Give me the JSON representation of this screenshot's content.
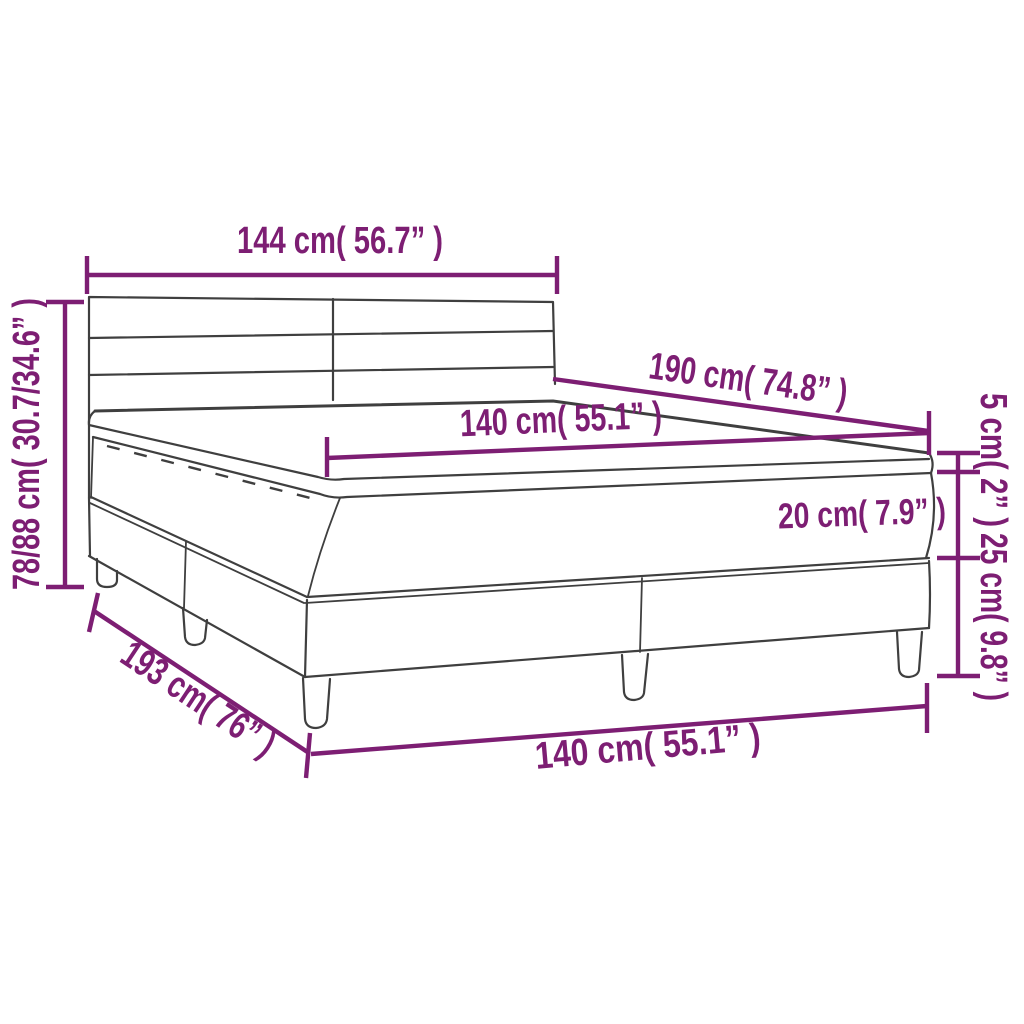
{
  "diagram": {
    "subject": "box spring bed with mattress and topper dimension drawing",
    "colors": {
      "accent": "#7d1e73",
      "line_art": "#3f3f3f",
      "background": "#ffffff"
    },
    "measurements": {
      "headboard_width": {
        "cm": "144",
        "inches": "56.7",
        "label": "144 cm( 56.7” )"
      },
      "total_height": {
        "cm": "78/88",
        "inches": "30.7/34.6",
        "label": "78/88 cm( 30.7/34.6” )"
      },
      "bed_length": {
        "cm": "190",
        "inches": "74.8",
        "label": "190 cm( 74.8” )"
      },
      "mattress_width": {
        "cm": "140",
        "inches": "55.1",
        "label": "140 cm( 55.1” )"
      },
      "mattress_thickness": {
        "cm": "20",
        "inches": "7.9",
        "label": "20 cm( 7.9” )"
      },
      "topper_thickness": {
        "cm": "5",
        "inches": "2",
        "label": "5 cm( 2” )"
      },
      "base_height": {
        "cm": "25",
        "inches": "9.8",
        "label": "25 cm( 9.8” )"
      },
      "base_length": {
        "cm": "193",
        "inches": "76",
        "label": "193 cm( 76” )"
      },
      "base_width": {
        "cm": "140",
        "inches": "55.1",
        "label": "140 cm( 55.1” )"
      }
    }
  }
}
